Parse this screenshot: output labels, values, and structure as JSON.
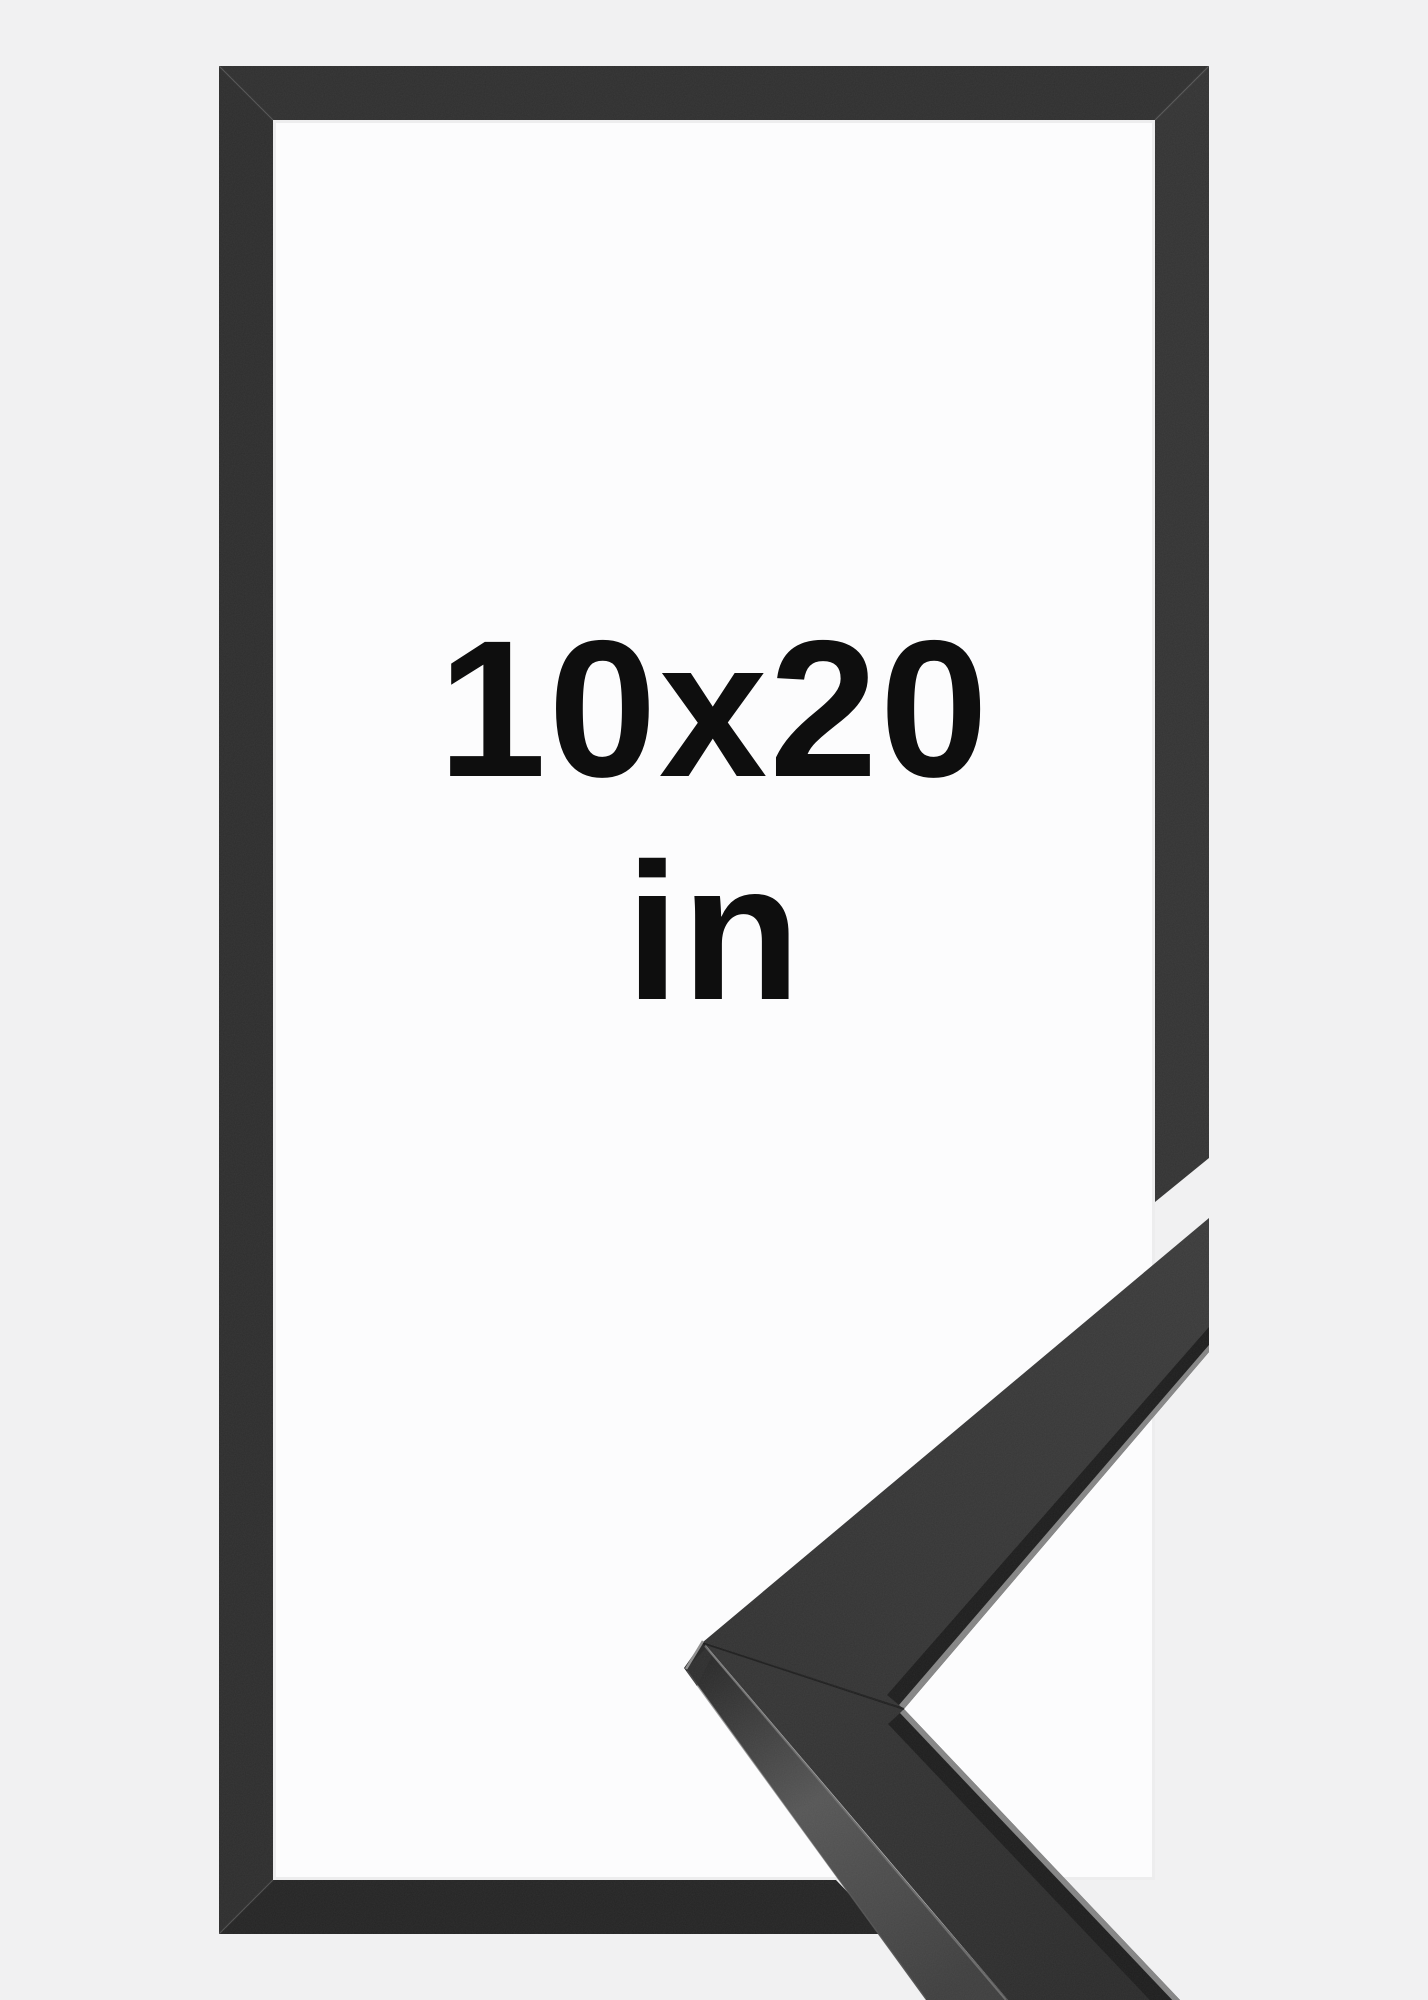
{
  "photo": {
    "description": "Product photo of a thin black picture frame shown face-on with a zoomed corner detail of the moulding profile overlapping the lower right",
    "size_label": {
      "line1": "10x20",
      "line2": "in"
    },
    "colors": {
      "background": "#f1f1f2",
      "opening": "#fcfcfd",
      "text": "#0e0e0e",
      "frame_top": "#2f2f2f",
      "frame_right": "#333333",
      "frame_left": "#2d2d2d",
      "frame_bottom": "#242424",
      "moulding_surface_upper": "#383838",
      "moulding_surface_lower": "#303030",
      "moulding_band": "#1d1d1d",
      "moulding_highlight": "#848484",
      "moulding_end_facet": "#2e2e2e"
    }
  }
}
